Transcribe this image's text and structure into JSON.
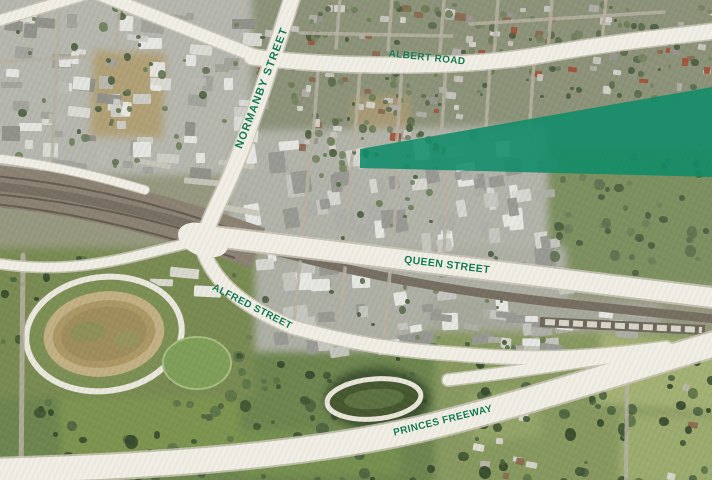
{
  "map": {
    "kind": "aerial-photo",
    "labels": {
      "albert_road": "ALBERT ROAD",
      "normanby_street": "NORMANBY STREET",
      "queen_street": "QUEEN STREET",
      "alfred_street": "ALFRED STREET",
      "princes_freeway": "PRINCES FREEWAY"
    },
    "label_color": "#15794f",
    "road_color": "#f1eee5",
    "highlight": {
      "color": "#0e8c69",
      "opacity": "0.87"
    }
  }
}
